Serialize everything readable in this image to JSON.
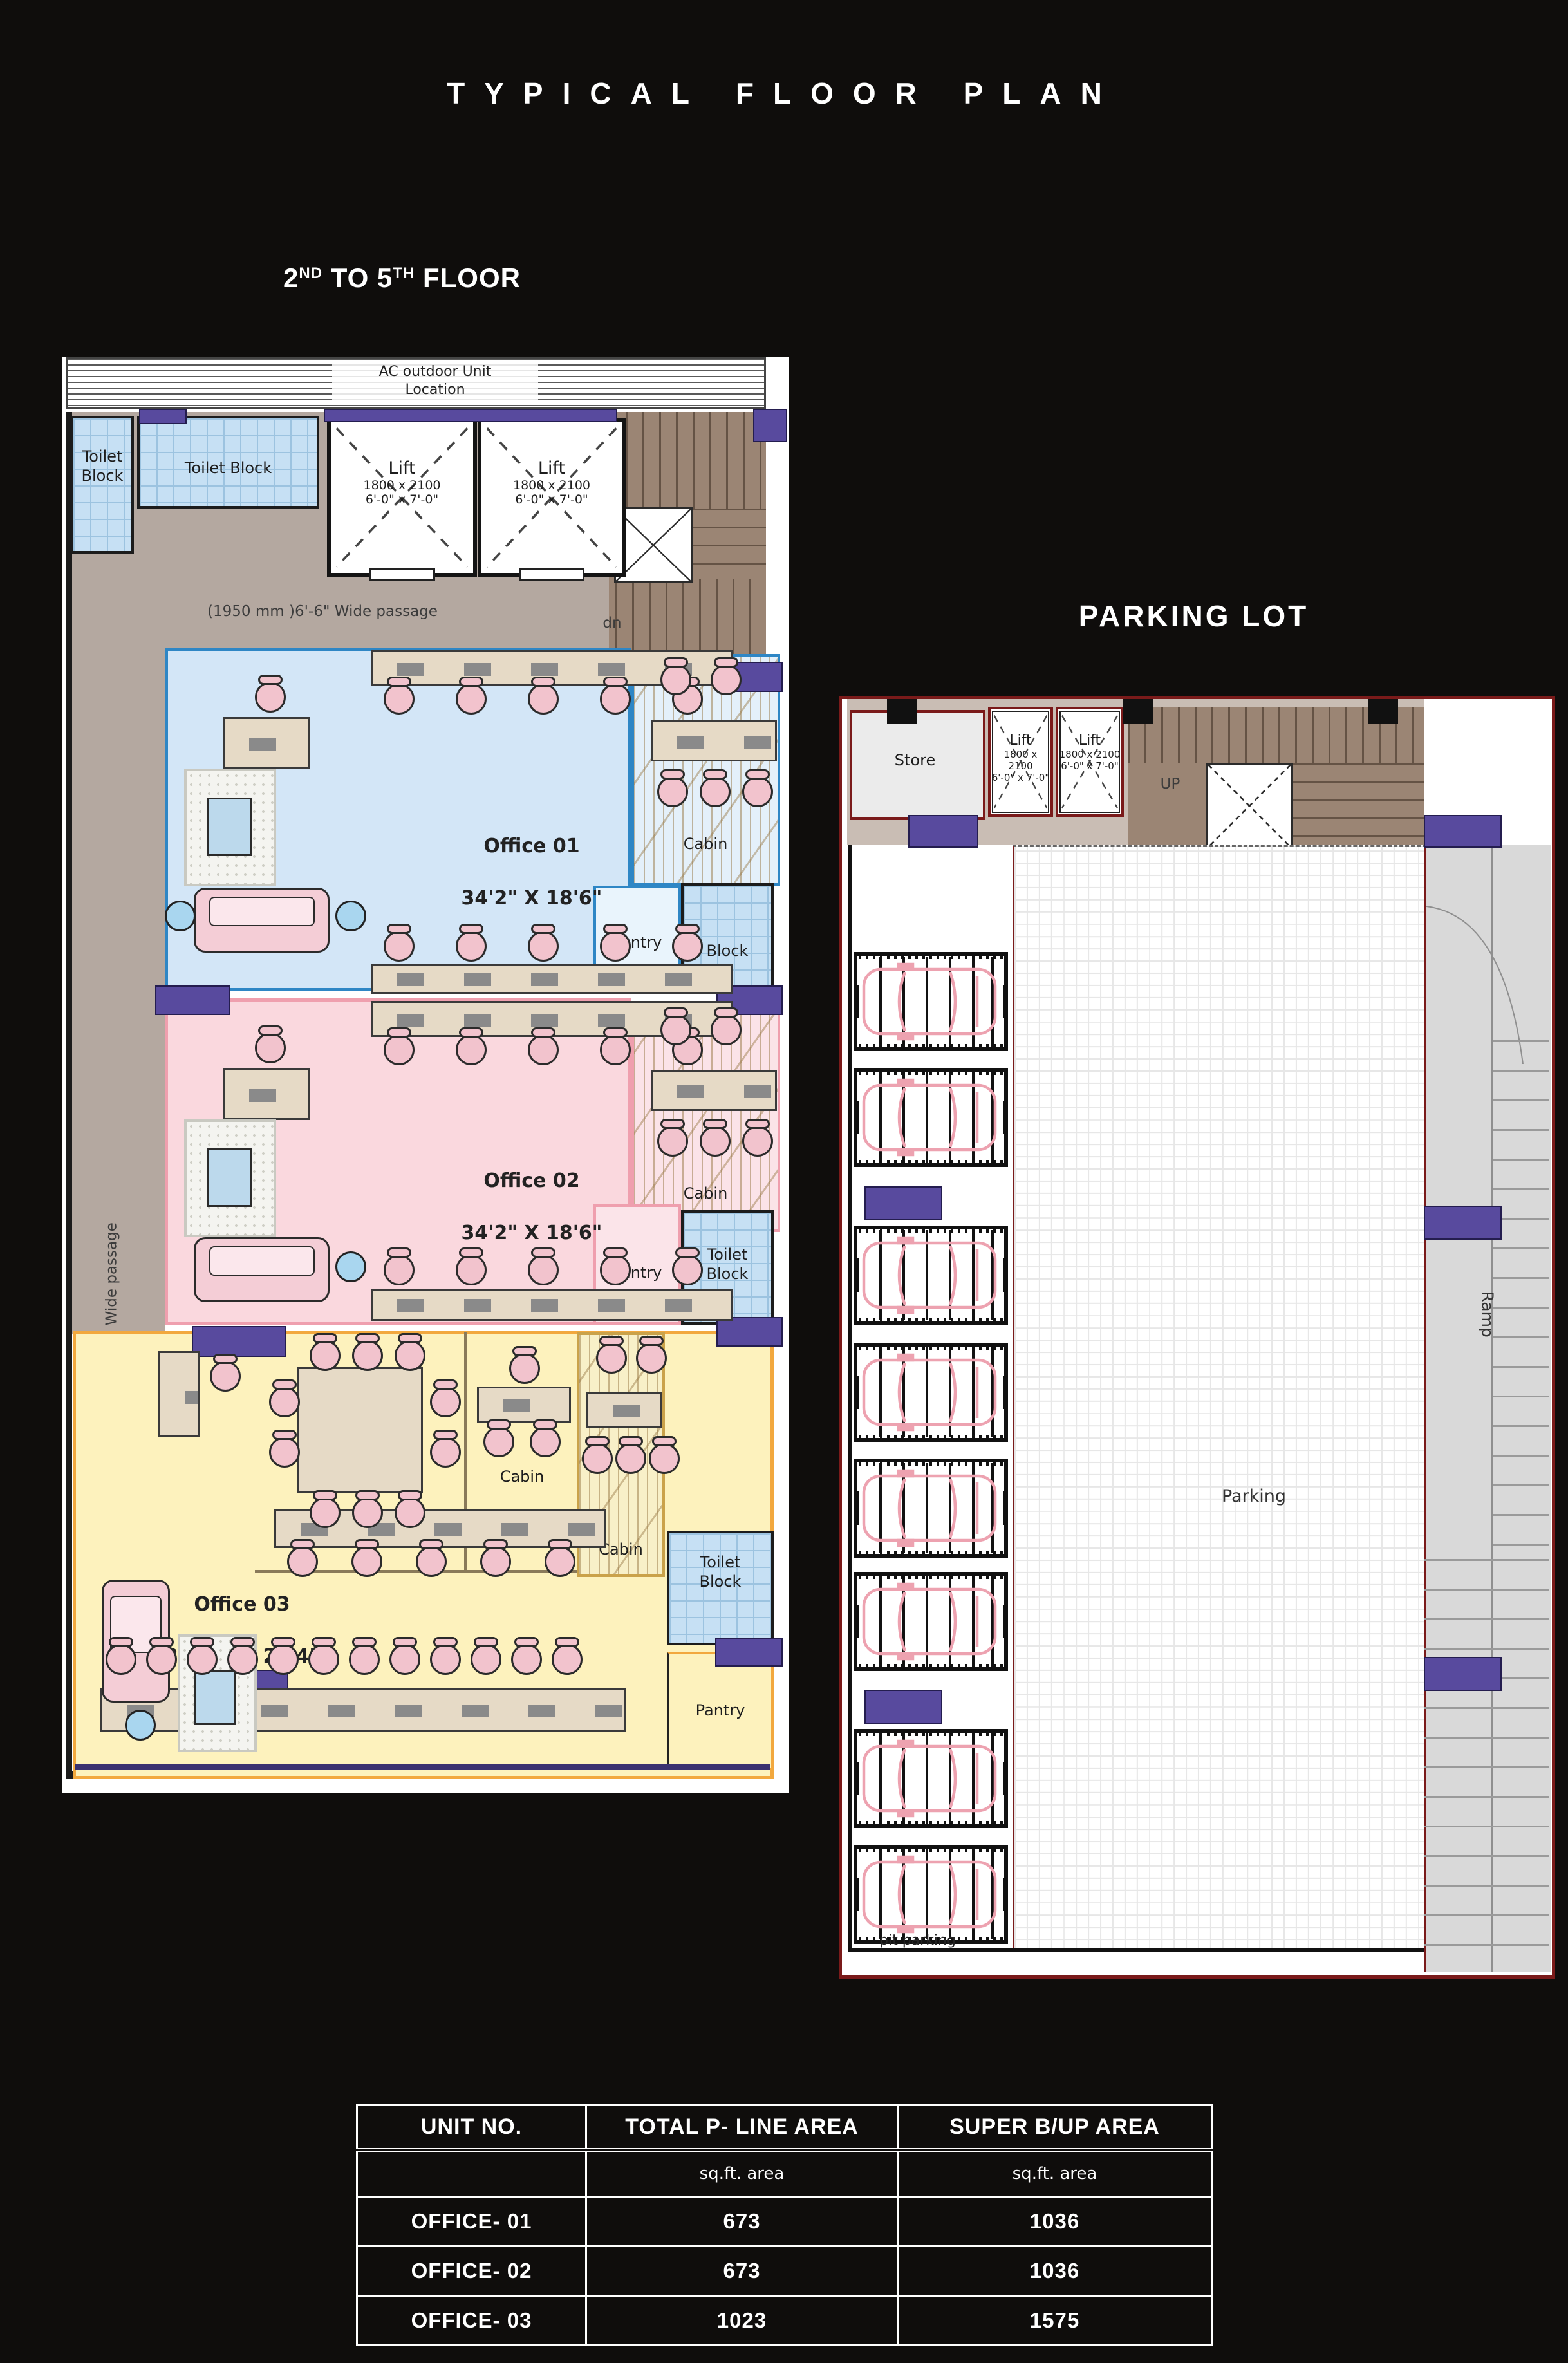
{
  "title": "TYPICAL FLOOR PLAN",
  "floor_heading": {
    "base1": "2",
    "sup1": "ND",
    "base2": " TO 5",
    "sup2": "TH",
    "base3": " FLOOR"
  },
  "floor_plan": {
    "ac_label": "AC outdoor Unit\nLocation",
    "toilet_block_small": "Toilet\nBlock",
    "toilet_block_wide": "Toilet Block",
    "lift_label": "Lift",
    "lift_size_mm": "1800 x 2100",
    "lift_size_ft": "6'-0\" x 7'-0\"",
    "stair_up": "up",
    "stair_dn": "dn",
    "passage_top_label": "(1950 mm )6'-6\" Wide passage",
    "passage_left_label": "5' Wide passage",
    "office1": {
      "name": "Office 01",
      "size": "34'2\" X 18'6\"",
      "cabin": "Cabin",
      "pantry": "Pantry",
      "toilet": "Block"
    },
    "office2": {
      "name": "Office 02",
      "size": "34'2\" X 18'6\"",
      "cabin": "Cabin",
      "pantry": "Pantry",
      "toilet": "Toilet\nBlock"
    },
    "office3": {
      "name": "Office 03",
      "size": "38'10\" X 24'4\"",
      "cabin_center": "Cabin",
      "cabin_right": "Cabin",
      "pantry": "Pantry",
      "toilet": "Toilet\nBlock"
    }
  },
  "parking_plan": {
    "title": "PARKING LOT",
    "store": "Store",
    "lift_label": "Lift",
    "lift_size_mm": "1800 x 2100",
    "lift_size_ft": "6'-0\" x 7'-0\"",
    "up": "UP",
    "parking": "Parking",
    "ramp": "Ramp",
    "pit_label": "pit parking"
  },
  "area_table": {
    "col1": "UNIT NO.",
    "col2": "TOTAL P- LINE AREA",
    "col3": "SUPER B/UP AREA",
    "sub2": "sq.ft. area",
    "sub3": "sq.ft. area",
    "rows": [
      {
        "unit": "OFFICE- 01",
        "pline": "673",
        "super": "1036"
      },
      {
        "unit": "OFFICE- 02",
        "pline": "673",
        "super": "1036"
      },
      {
        "unit": "OFFICE- 03",
        "pline": "1023",
        "super": "1575"
      }
    ]
  }
}
